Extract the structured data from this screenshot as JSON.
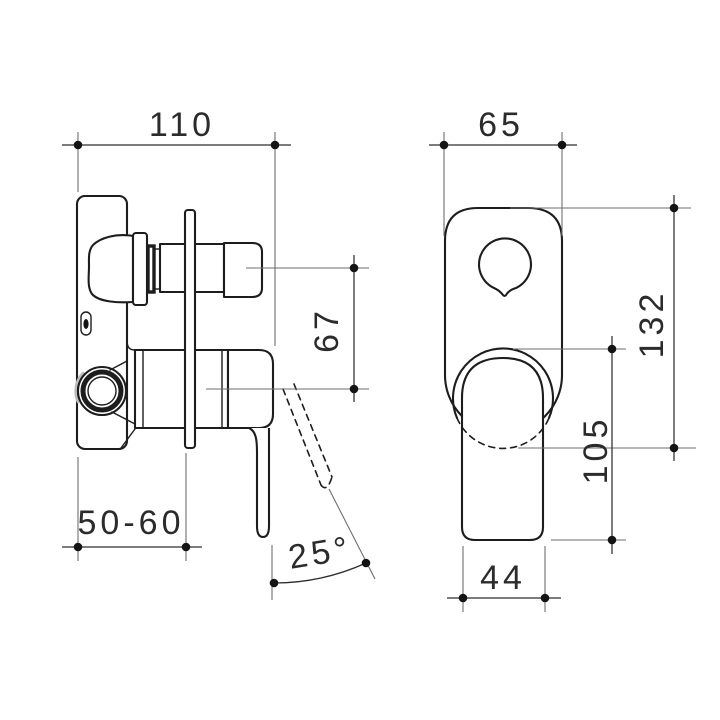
{
  "drawing": {
    "kind": "technical-dimension-drawing",
    "subject": "wall-mixer-with-diverter",
    "background": "#ffffff",
    "object_line_color": "#1d1d1d",
    "dimension_line_color": "#2e2e2e",
    "extension_line_color": "#6e6e6e",
    "dimensions": {
      "side_view": {
        "overall_depth": "110",
        "port_spacing": "67",
        "wall_fixing_range": "50-60",
        "handle_swing_angle": "25°"
      },
      "front_view": {
        "plate_width": "65",
        "plate_height": "132",
        "handle_assembly_height": "105",
        "handle_width": "44"
      }
    }
  }
}
